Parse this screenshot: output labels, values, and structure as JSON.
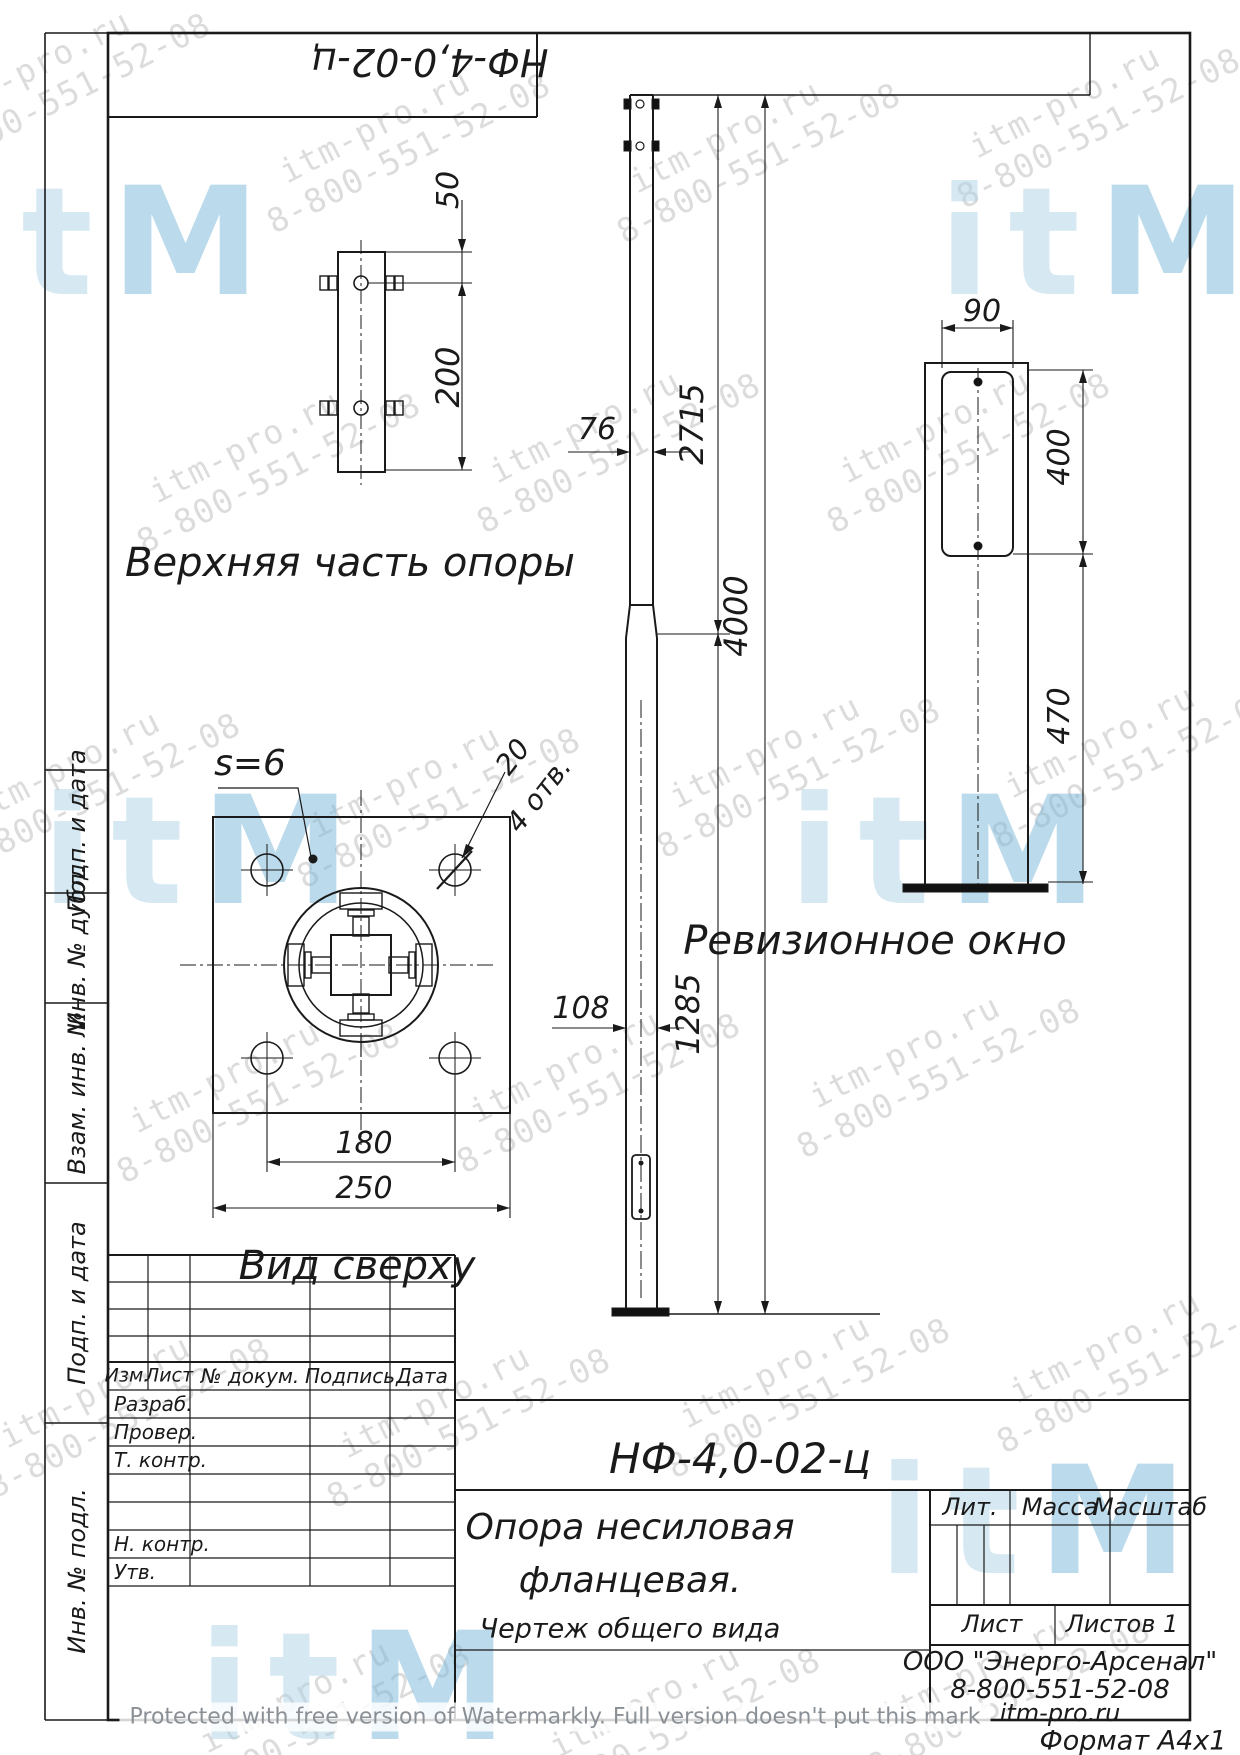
{
  "sheet": {
    "top_designation": "НФ-4,0-02-ц",
    "format_note": "Формат  А4х1"
  },
  "views": {
    "upper_part_label": "Верхняя часть опоры",
    "top_view_label": "Вид сверху",
    "revision_window_label": "Ревизионное окно",
    "thickness_note": "s=6",
    "hole_note_dia": "20",
    "hole_note_count": "4 отв."
  },
  "dimensions": {
    "d50": "50",
    "d200": "200",
    "d76": "76",
    "d2715": "2715",
    "d4000": "4000",
    "d108": "108",
    "d1285": "1285",
    "d180": "180",
    "d250": "250",
    "d90": "90",
    "d400": "400",
    "d470": "470"
  },
  "title_block": {
    "designation": "НФ-4,0-02-ц",
    "name_line1": "Опора несиловая",
    "name_line2": "фланцевая.",
    "doc_type": "Чертеж общего вида",
    "lit_label": "Лит.",
    "mass_label": "Масса",
    "scale_label": "Масштаб",
    "sheet_label": "Лист",
    "sheets_label": "Листов 1",
    "org_name": "ООО \"Энерго-Арсенал\"",
    "org_phone": "8-800-551-52-08",
    "org_site": "itm-pro.ru",
    "header": {
      "izm": "Изм.",
      "list": "Лист",
      "doc": "№ докум.",
      "sign": "Подпись",
      "date": "Дата"
    },
    "rows": {
      "razrab": "Разраб.",
      "prover": "Провер.",
      "tkontr": "Т. контр.",
      "nkontr": "Н. контр.",
      "utv": "Утв."
    }
  },
  "side_labels": [
    "Подп. и дата",
    "Инв. № дубл.",
    "Взам. инв. №",
    "Подп. и дата",
    "Инв. № подл."
  ],
  "watermark": {
    "site": "itm-pro.ru",
    "phone": "8-800-551-52-08",
    "logo_letters": [
      "i",
      "t",
      "m"
    ],
    "protect_note": "Protected with free version of Watermarkly. Full version doesn't put this mark",
    "gray_color": "#c7c7c7",
    "blue_color": "#aed3e6",
    "blue_dark_color": "#79b7d9"
  }
}
